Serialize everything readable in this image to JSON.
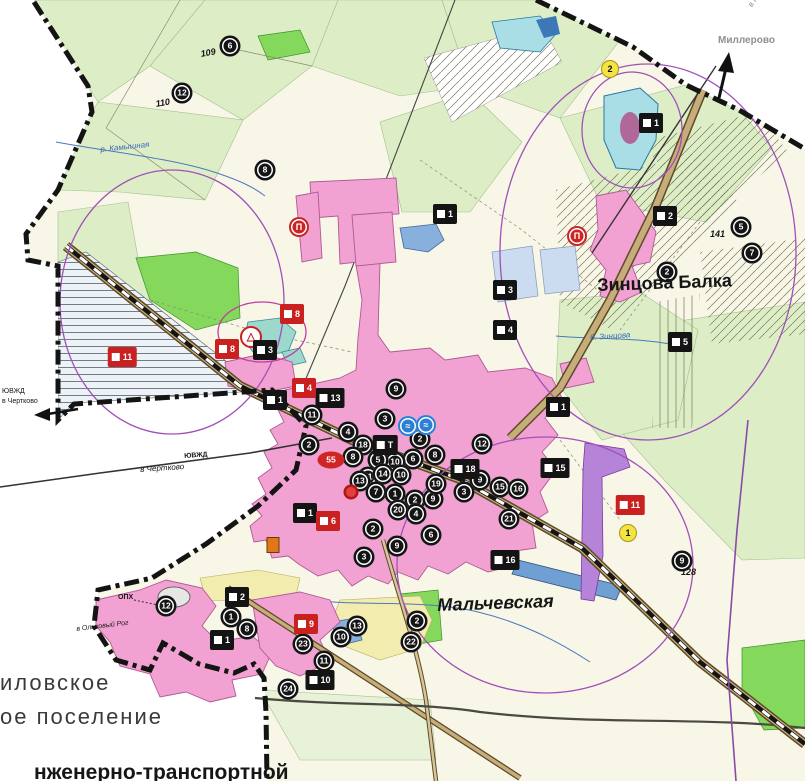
{
  "map": {
    "place_labels": [
      {
        "text": "Зинцова Балка",
        "x": 597,
        "y": 276,
        "size": 18,
        "weight": 700,
        "rot": -2,
        "name": "label-zintsova-balka"
      },
      {
        "text": "Мальчевская",
        "x": 437,
        "y": 596,
        "size": 18,
        "weight": 700,
        "italic": true,
        "rot": -2,
        "name": "label-malchevskaya"
      },
      {
        "text": "иловское",
        "x": 0,
        "y": 672,
        "size": 22,
        "cls": "muni",
        "name": "label-settlement-line1"
      },
      {
        "text": "ое поселение",
        "x": 0,
        "y": 706,
        "size": 22,
        "cls": "muni",
        "name": "label-settlement-line2"
      },
      {
        "text": "нженерно-транспортной",
        "x": 34,
        "y": 762,
        "size": 21,
        "weight": 700,
        "name": "label-title-fragment"
      },
      {
        "text": "Миллерово",
        "x": 718,
        "y": 36,
        "size": 10,
        "weight": 700,
        "cls": "faded",
        "name": "label-millerovo"
      },
      {
        "text": "в Миллерово",
        "x": 747,
        "y": 4,
        "size": 8,
        "rot": -53,
        "cls": "faded",
        "name": "label-to-millerovo"
      },
      {
        "text": "в Чертково",
        "x": 140,
        "y": 466,
        "size": 8,
        "italic": true,
        "rot": -4,
        "name": "label-to-chertkovo"
      },
      {
        "text": "ЮВЖД",
        "x": 184,
        "y": 453,
        "size": 7,
        "weight": 700,
        "rot": -4,
        "name": "label-railway"
      },
      {
        "text": "ЮВЖД",
        "x": 2,
        "y": 388,
        "size": 7,
        "name": "label-railway-west"
      },
      {
        "text": "в Чертково",
        "x": 2,
        "y": 398,
        "size": 7,
        "name": "label-to-chertkovo-west"
      },
      {
        "text": "в Ольховый Рог",
        "x": 76,
        "y": 626,
        "size": 7,
        "italic": true,
        "rot": -7,
        "name": "label-to-olkhovy-rog"
      },
      {
        "text": "ОПХ",
        "x": 118,
        "y": 594,
        "size": 7,
        "weight": 700,
        "name": "label-opkh"
      },
      {
        "text": "110",
        "x": 155,
        "y": 100,
        "size": 9,
        "italic": true,
        "weight": 700,
        "rot": -10,
        "name": "label-parcel-110"
      },
      {
        "text": "109",
        "x": 200,
        "y": 50,
        "size": 9,
        "italic": true,
        "weight": 700,
        "rot": -10,
        "name": "label-parcel-109"
      },
      {
        "text": "141",
        "x": 710,
        "y": 230,
        "size": 9,
        "italic": true,
        "weight": 700,
        "name": "label-parcel-141"
      },
      {
        "text": "128",
        "x": 681,
        "y": 568,
        "size": 9,
        "italic": true,
        "weight": 700,
        "name": "label-parcel-128"
      },
      {
        "text": "б. Зинцова",
        "x": 590,
        "y": 334,
        "size": 8,
        "italic": true,
        "cls": "river",
        "rot": -4,
        "name": "label-zintsova-stream"
      },
      {
        "text": "р. Камышная",
        "x": 100,
        "y": 146,
        "size": 8,
        "italic": true,
        "cls": "river",
        "rot": -6,
        "name": "label-kamyshnaya-river"
      }
    ],
    "markers_format": [
      "type",
      "x",
      "y",
      "number"
    ],
    "markers": [
      [
        "ring",
        230,
        46,
        "6"
      ],
      [
        "ring",
        182,
        93,
        "12"
      ],
      [
        "ring",
        265,
        170,
        "8"
      ],
      [
        "ring",
        741,
        227,
        "5"
      ],
      [
        "ring",
        752,
        253,
        "7"
      ],
      [
        "ring",
        667,
        272,
        "2"
      ],
      [
        "ring",
        682,
        561,
        "9"
      ],
      [
        "ring",
        166,
        606,
        "12"
      ],
      [
        "ring",
        231,
        617,
        "1"
      ],
      [
        "ring",
        247,
        629,
        "8"
      ],
      [
        "ring",
        303,
        644,
        "23"
      ],
      [
        "ring",
        341,
        637,
        "10"
      ],
      [
        "ring",
        324,
        661,
        "11"
      ],
      [
        "ring",
        357,
        626,
        "13"
      ],
      [
        "ring",
        288,
        689,
        "24"
      ],
      [
        "ring",
        417,
        621,
        "2"
      ],
      [
        "ring",
        411,
        642,
        "22"
      ],
      [
        "ring",
        312,
        415,
        "11"
      ],
      [
        "ring",
        348,
        432,
        "4"
      ],
      [
        "ring",
        363,
        445,
        "18"
      ],
      [
        "ring",
        385,
        419,
        "3"
      ],
      [
        "ring",
        396,
        389,
        "9"
      ],
      [
        "ring",
        420,
        439,
        "2"
      ],
      [
        "ring",
        435,
        455,
        "8"
      ],
      [
        "ring",
        413,
        459,
        "6"
      ],
      [
        "ring",
        395,
        462,
        "10"
      ],
      [
        "ring",
        378,
        460,
        "5"
      ],
      [
        "ring",
        353,
        457,
        "8"
      ],
      [
        "ring",
        368,
        477,
        "11"
      ],
      [
        "ring",
        383,
        474,
        "14"
      ],
      [
        "ring",
        401,
        475,
        "10"
      ],
      [
        "ring",
        360,
        481,
        "13"
      ],
      [
        "ring",
        376,
        492,
        "7"
      ],
      [
        "ring",
        395,
        494,
        "1"
      ],
      [
        "ring",
        415,
        500,
        "2"
      ],
      [
        "ring",
        433,
        499,
        "9"
      ],
      [
        "ring",
        398,
        510,
        "20"
      ],
      [
        "ring",
        416,
        514,
        "4"
      ],
      [
        "ring",
        373,
        529,
        "2"
      ],
      [
        "ring",
        436,
        484,
        "19"
      ],
      [
        "ring",
        309,
        445,
        "2"
      ],
      [
        "ring",
        431,
        535,
        "6"
      ],
      [
        "ring",
        397,
        546,
        "9"
      ],
      [
        "ring",
        364,
        557,
        "3"
      ],
      [
        "ring",
        482,
        444,
        "12"
      ],
      [
        "ring",
        480,
        480,
        "9"
      ],
      [
        "ring",
        500,
        487,
        "15"
      ],
      [
        "ring",
        518,
        489,
        "16"
      ],
      [
        "ring",
        464,
        492,
        "3"
      ],
      [
        "ring",
        509,
        519,
        "21"
      ],
      [
        "bring",
        408,
        426,
        "≈"
      ],
      [
        "bring",
        426,
        425,
        "≈"
      ],
      [
        "rring",
        299,
        227,
        "П"
      ],
      [
        "rring",
        577,
        236,
        "П"
      ],
      [
        "warn",
        251,
        337,
        "△"
      ],
      [
        "rell",
        331,
        460,
        "55"
      ],
      [
        "rdot",
        351,
        492,
        ""
      ],
      [
        "yel",
        610,
        69,
        "2"
      ],
      [
        "yel",
        628,
        533,
        "1"
      ],
      [
        "rb",
        651,
        123,
        "1"
      ],
      [
        "rb",
        665,
        216,
        "2"
      ],
      [
        "rb",
        445,
        214,
        "1"
      ],
      [
        "rb",
        505,
        290,
        "3"
      ],
      [
        "rb",
        505,
        330,
        "4"
      ],
      [
        "rb",
        558,
        407,
        "1"
      ],
      [
        "rb",
        555,
        468,
        "15"
      ],
      [
        "rb",
        465,
        469,
        "18"
      ],
      [
        "rb",
        385,
        445,
        "Т"
      ],
      [
        "rb",
        305,
        513,
        "1"
      ],
      [
        "rb",
        330,
        398,
        "13"
      ],
      [
        "rb",
        275,
        400,
        "1"
      ],
      [
        "rb",
        265,
        350,
        "3"
      ],
      [
        "rb",
        680,
        342,
        "5"
      ],
      [
        "rb",
        237,
        597,
        "2"
      ],
      [
        "rb",
        222,
        640,
        "1"
      ],
      [
        "rb",
        320,
        680,
        "10"
      ],
      [
        "rb",
        505,
        560,
        "16"
      ],
      [
        "rr",
        292,
        314,
        "8"
      ],
      [
        "rr",
        122,
        357,
        "11"
      ],
      [
        "rr",
        227,
        349,
        "8"
      ],
      [
        "rr",
        304,
        388,
        "4"
      ],
      [
        "rr",
        306,
        624,
        "9"
      ],
      [
        "rr",
        630,
        505,
        "11"
      ],
      [
        "rr",
        328,
        521,
        "6"
      ],
      [
        "org",
        273,
        545,
        ""
      ]
    ],
    "palette": {
      "residential_pink": "#f2a2d2",
      "fields_green": "#ddeec6",
      "base_cream": "#f8f6e6",
      "meadow_green": "#84d95c",
      "water_blue": "#88b0dc",
      "water_cyan": "#aadee6",
      "zone_violet": "#b583d8",
      "spz_purple": "#a050b8",
      "road_tan": "#c7ad7a",
      "boundary_black": "#141414",
      "marker_red": "#c92020",
      "marker_yellow": "#f3e343",
      "marker_blue": "#2b7fd4"
    }
  }
}
